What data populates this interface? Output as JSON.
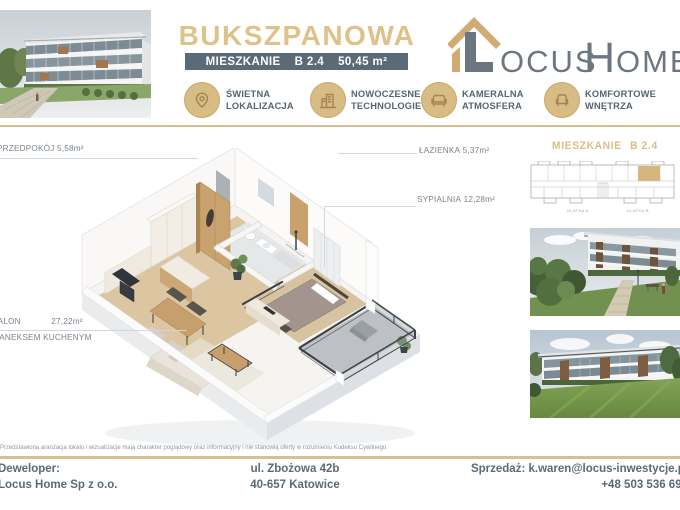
{
  "colors": {
    "accent_gold": "#d9bd85",
    "slate": "#5b6a77",
    "highlight_unit": "#d6b57e"
  },
  "header": {
    "title": "BUKSZPANOWA",
    "subtitle": {
      "label": "MIESZKANIE",
      "unit": "B 2.4",
      "area": "50,45 m²"
    },
    "logo": {
      "brand": "Locus Home",
      "text_ocus": "OCUS",
      "text_h": "H",
      "text_ome": "OME"
    },
    "features": [
      {
        "icon": "location-pin-icon",
        "line1": "ŚWIETNA",
        "line2": "LOKALIZACJA"
      },
      {
        "icon": "buildings-icon",
        "line1": "NOWOCZESNE",
        "line2": "TECHNOLOGIE"
      },
      {
        "icon": "sofa-icon",
        "line1": "KAMERALNA",
        "line2": "ATMOSFERA"
      },
      {
        "icon": "armchair-icon",
        "line1": "KOMFORTOWE",
        "line2": "WNĘTRZA"
      }
    ]
  },
  "floorplan": {
    "labels": [
      {
        "name": "PRZEDPOKÓJ",
        "area": "5,58m²"
      },
      {
        "name": "ŁAZIENKA",
        "area": "5,37m²"
      },
      {
        "name": "SYPIALNIA",
        "area": "12,28m²"
      },
      {
        "name": "SALON",
        "area": "27,22m²",
        "name2": "Z ANEKSEM KUCHENYM"
      }
    ]
  },
  "sidebar": {
    "heading_label": "MIESZKANIE",
    "heading_unit": "B 2.4",
    "klatka_a": "KLATKA A",
    "klatka_b": "KLATKA B"
  },
  "footer": {
    "disclaimer": "Przedstawiona aranżacja lokalu i wizualizacje mają charakter poglądowy oraz informacyjny i nie stanowią oferty w rozumieniu Kodeksu Cywilnego",
    "developer_label": "Deweloper:",
    "developer_name": "Locus Home Sp z o.o.",
    "address_line1": "ul. Zbożowa 42b",
    "address_line2": "40-657 Katowice",
    "sales_label": "Sprzedaż:",
    "sales_email": "k.waren@locus-inwestycje.pl",
    "sales_phone": "+48 503 536 699"
  }
}
